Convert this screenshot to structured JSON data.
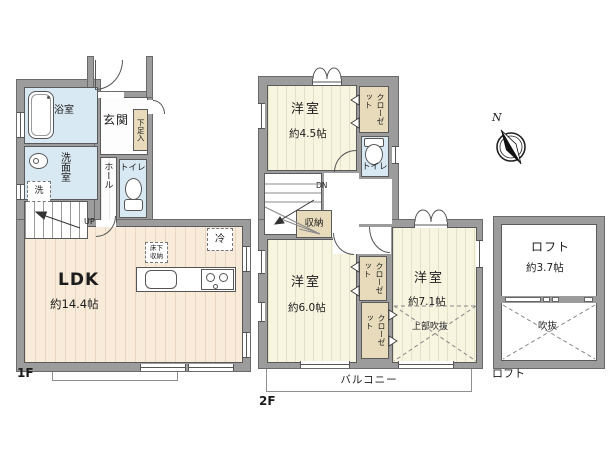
{
  "colors": {
    "wall": "#9c9c9c",
    "wet_room": "#d9e9f3",
    "wood_floor": "#f8ebd9",
    "tatami_floor": "#f7f4e0",
    "storage": "#e8dbbb",
    "outline": "#5a5a5a"
  },
  "compass": {
    "north_label": "N"
  },
  "floor1": {
    "label": "1F",
    "bath": "浴室",
    "washroom": "洗面室",
    "washer": "洗",
    "entrance": "玄関",
    "shoe_cabinet": "下足入",
    "hall": "ホール",
    "toilet": "トイレ",
    "stairs_up": "UP",
    "ldk_name": "LDK",
    "ldk_size": "約14.4帖",
    "floor_storage": "床下\n収納",
    "fridge": "冷"
  },
  "floor2": {
    "label": "2F",
    "bedroom_a_name": "洋室",
    "bedroom_a_size": "約4.5帖",
    "closet_a": "クローゼット",
    "toilet": "トイレ",
    "stairs_down": "DN",
    "storage": "収納",
    "bedroom_b_name": "洋室",
    "bedroom_b_size": "約6.0帖",
    "closet_b": "クローゼット",
    "closet_c": "クローゼット",
    "bedroom_c_name": "洋室",
    "bedroom_c_size": "約7.1帖",
    "void_above": "上部吹抜",
    "balcony": "バルコニー"
  },
  "loft": {
    "label": "ロフト",
    "name": "ロフト",
    "size": "約3.7帖",
    "void": "吹抜"
  }
}
